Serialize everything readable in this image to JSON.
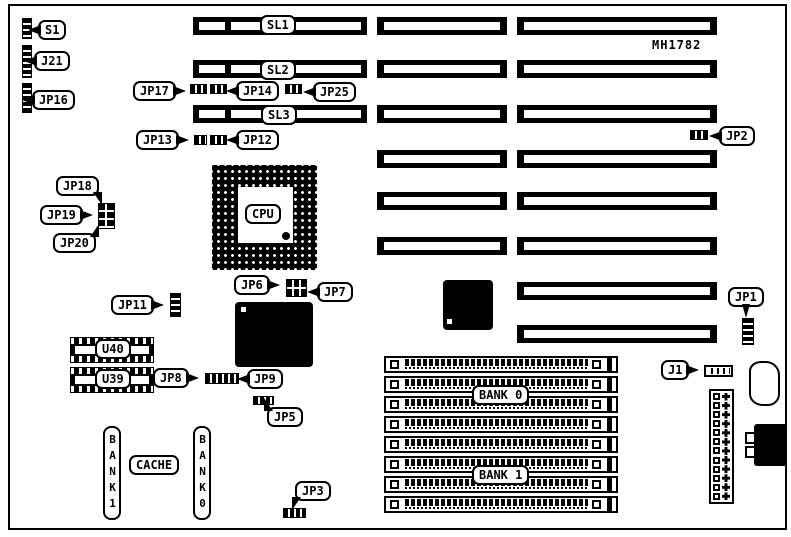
{
  "board": {
    "part_number": "MH1782"
  },
  "slots": {
    "sl1": "SL1",
    "sl2": "SL2",
    "sl3": "SL3"
  },
  "callouts": {
    "s1": "S1",
    "j21": "J21",
    "jp16": "JP16",
    "jp17": "JP17",
    "jp14": "JP14",
    "jp25": "JP25",
    "jp13": "JP13",
    "jp12": "JP12",
    "jp2": "JP2",
    "jp18": "JP18",
    "jp19": "JP19",
    "jp20": "JP20",
    "jp11": "JP11",
    "jp6": "JP6",
    "jp7": "JP7",
    "jp8": "JP8",
    "jp9": "JP9",
    "jp5": "JP5",
    "jp3": "JP3",
    "jp1": "JP1",
    "j1": "J1"
  },
  "components": {
    "cpu": "CPU",
    "u40": "U40",
    "u39": "U39"
  },
  "memory": {
    "bank0": "BANK 0",
    "bank1": "BANK 1"
  },
  "cache": {
    "bank1_vertical": "BANK1",
    "label": "CACHE",
    "bank0_vertical": "BANK0"
  },
  "colors": {
    "ink": "#000000",
    "paper": "#ffffff"
  }
}
